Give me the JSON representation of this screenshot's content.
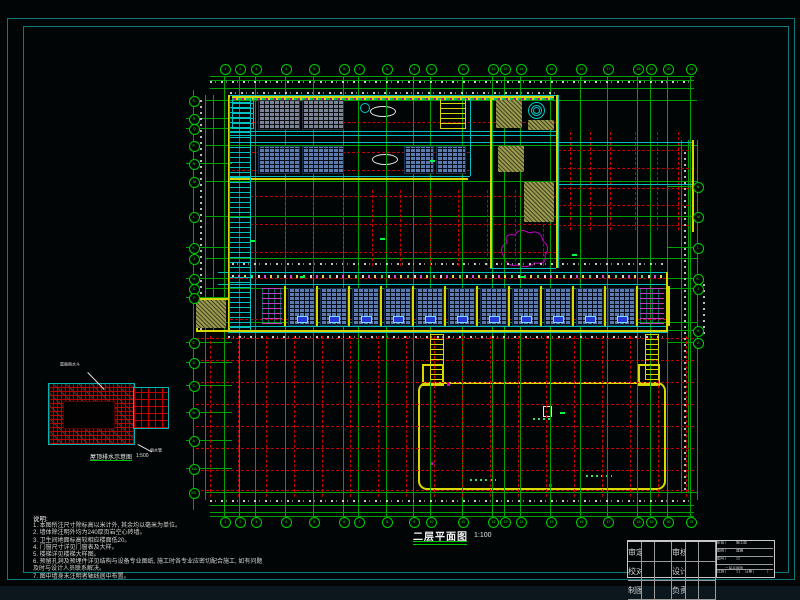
{
  "drawing": {
    "main_title": "二层平面图",
    "main_title_scale": "1:100",
    "key_plan_caption": "屋顶排水示意图",
    "key_plan_scale": "1:500",
    "key_plan_note_top": "屋面雨水斗",
    "key_plan_note_bottom": "雨水管"
  },
  "notes": {
    "header": "说明:",
    "lines": [
      "1. 本图所注尺寸除标高以米计外, 其余均以毫米为单位。",
      "2. 墙体除注明外均为240厚页岩空心砖墙。",
      "3. 卫生间地面标高较相应楼面低20。",
      "4. 门窗尺寸详见门窗表及大样。",
      "5. 楼梯详见楼梯大样图。",
      "6. 预留孔洞及预埋件详见结构与设备专业图纸, 施工时各专业应密切配合施工, 如有问题",
      "   及时与设计人员联系解决。",
      "7. 图中墙身未注明者轴线居中布置。"
    ]
  },
  "axes": {
    "top": [
      "1",
      "2",
      "3",
      "4",
      "5",
      "6",
      "7",
      "8",
      "9",
      "10",
      "11",
      "12",
      "13",
      "14",
      "15",
      "16",
      "17",
      "18",
      "19",
      "20",
      "21"
    ],
    "left": [
      "S",
      "R",
      "Q",
      "P",
      "N",
      "M",
      "L",
      "K",
      "J",
      "H",
      "G",
      "F"
    ],
    "left_lower": [
      "E",
      "D",
      "C",
      "B",
      "A",
      "1/A",
      "1/0"
    ],
    "right": [
      "N",
      "M",
      "L",
      "K",
      "J",
      "H",
      "G"
    ]
  },
  "title_block": {
    "company": "××市建筑设计研究院有限公司",
    "logo_glyph": "建",
    "project_value": "××小学教学楼",
    "drawing_name_value": "二层平面图",
    "fields_left": [
      {
        "label": "审定",
        "value": ""
      },
      {
        "label": "审核",
        "value": ""
      },
      {
        "label": "校对",
        "value": ""
      },
      {
        "label": "设计",
        "value": ""
      },
      {
        "label": "制图",
        "value": ""
      },
      {
        "label": "负责",
        "value": ""
      }
    ],
    "fields_right": [
      {
        "label": "阶段",
        "value": "施工图"
      },
      {
        "label": "图别",
        "value": "建施"
      },
      {
        "label": "图号",
        "value": "12"
      }
    ],
    "scale_label": "比例",
    "scale_value": "1:100",
    "date_label": "日期",
    "date_value": ""
  },
  "colors": {
    "grid_green": "#00a000",
    "dashed_red": "#c40000",
    "wall_yellow": "#d6d600",
    "window_cyan": "#00bebe",
    "highlight_magenta": "#c800c8",
    "sheet_border_teal": "#0f7878"
  }
}
